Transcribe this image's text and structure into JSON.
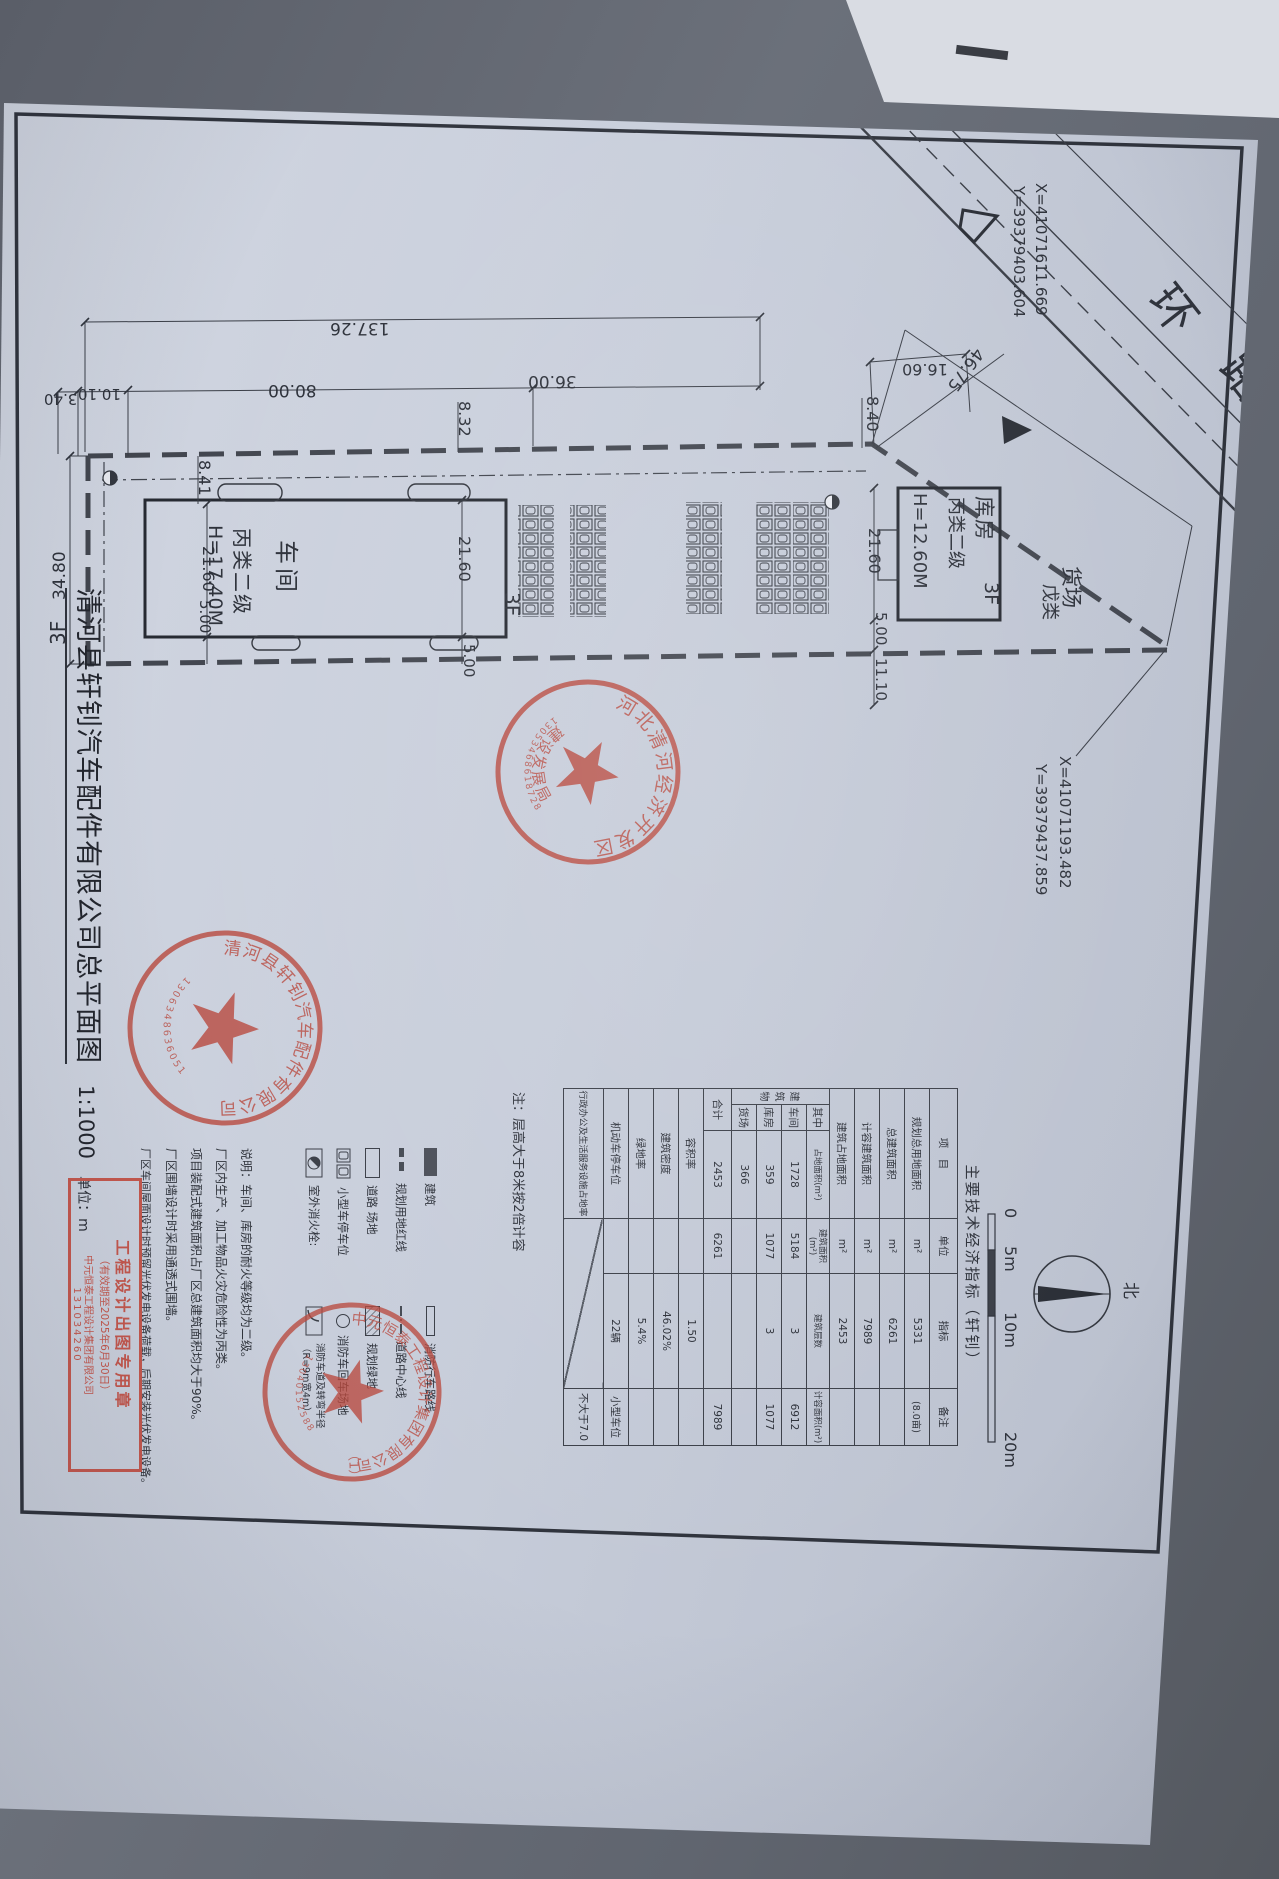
{
  "title_block": {
    "title": "清河县轩钊汽车配件有限公司总平面图",
    "scale": "1:1000",
    "unit": "单位：m"
  },
  "road": {
    "char1": "环",
    "char2": "路"
  },
  "coordinates": {
    "north_corner": {
      "x": "X=41071611.669",
      "y": "Y=39379403.604"
    },
    "east_corner": {
      "x": "X=41071193.482",
      "y": "Y=39379437.859"
    }
  },
  "buildings": {
    "workshop": {
      "name": "车间",
      "fire_class": "丙类二级",
      "height": "H=17.40M",
      "floors": "3F"
    },
    "warehouse": {
      "name": "库房",
      "fire_class": "丙类二级",
      "height": "H=12.60M",
      "floors": "3F"
    },
    "freight_yard": {
      "name": "货场",
      "fire_class": "戊类"
    }
  },
  "dims": {
    "total_length": "137.26",
    "seg_3_40": "3.40",
    "seg_10_10": "10.10",
    "seg_80_00": "80.00",
    "seg_36_00": "36.00",
    "seg_16_60": "16.60",
    "gap_8_40": "8.40",
    "gap_8_32": "8.32",
    "gap_8_41": "8.41",
    "depth_21_60": "21.60",
    "gap_5_00": "5.00",
    "gap_11_10": "11.10",
    "total_width": "34.80",
    "road_frontage": "46.75",
    "floors_3f": "3F"
  },
  "compass": {
    "north": "北"
  },
  "scale_bar": {
    "labels": [
      "0",
      "5m",
      "10m",
      "20m"
    ]
  },
  "economic_table": {
    "title": "主要技术经济指标（轩钊）",
    "note": "注：层高大于8米按2倍计容",
    "headers": {
      "item": "项　目",
      "unit": "单位",
      "value": "指标",
      "remark": "备注"
    },
    "rows_main": [
      {
        "label": "规划总用地面积",
        "unit": "m²",
        "value": "5331",
        "remark": "(8.0亩)"
      },
      {
        "label": "总建筑面积",
        "unit": "m²",
        "value": "6261",
        "remark": ""
      },
      {
        "label": "计容建筑面积",
        "unit": "m²",
        "value": "7989",
        "remark": ""
      },
      {
        "label": "建筑占地面积",
        "unit": "m²",
        "value": "2453",
        "remark": ""
      }
    ],
    "building_section": {
      "group_label": "建筑物",
      "among_label": "其中",
      "sub_headers": [
        "占地面积(m²)",
        "建筑面积(m²)",
        "建筑层数",
        "计容面积(m²)"
      ],
      "rows": [
        {
          "label": "车间",
          "values": [
            "1728",
            "5184",
            "3",
            "6912"
          ]
        },
        {
          "label": "库房",
          "values": [
            "359",
            "1077",
            "3",
            "1077"
          ]
        },
        {
          "label": "货场",
          "values": [
            "366",
            "",
            "",
            ""
          ]
        },
        {
          "label": "合计",
          "values": [
            "2453",
            "6261",
            "",
            "7989"
          ]
        }
      ]
    },
    "rows_bottom": [
      {
        "label": "容积率",
        "value": "1.50",
        "remark": ""
      },
      {
        "label": "建筑密度",
        "value": "46.02%",
        "remark": ""
      },
      {
        "label": "绿地率",
        "value": "5.4%",
        "remark": ""
      },
      {
        "label": "机动车停车位",
        "value": "22辆",
        "remark": "小型车位"
      },
      {
        "label": "行政办公及生活服务设施占地率",
        "value": "",
        "remark": "不大于7.0"
      }
    ]
  },
  "legend": {
    "col1": [
      {
        "label": "建筑"
      },
      {
        "label": "规划用地红线"
      },
      {
        "label": "道路 场地"
      },
      {
        "label": "小型车停车位"
      },
      {
        "label": "室外消火栓:"
      }
    ],
    "col2": [
      {
        "label": "消防行车路线"
      },
      {
        "label": "道路中心线"
      },
      {
        "label": "规划绿地"
      },
      {
        "label": "消防车回车场地"
      },
      {
        "label": "消防车道及转弯半径（R=9m宽4m）"
      }
    ]
  },
  "notes": {
    "lines": [
      "说明：车间、库房的耐火等级均为二级。",
      "厂区内生产、加工物品火灾危险性为丙类。",
      "项目装配式建筑面积占厂区总建筑面积均大于90%。",
      "厂区围墙设计时采用通透式围墙。",
      "厂区车间屋面设计时预留光伏发电设备荷载，后期安装光伏发电设备。"
    ]
  },
  "stamps": {
    "devzone": {
      "ring_top": "河北清河经济开发区",
      "ring_bottom": "建设发展局",
      "serial": "13053468618728"
    },
    "company": {
      "ring": "清河县轩钊汽车配件有限公司",
      "serial": "1306348636051"
    },
    "design": {
      "ring": "中元恒泰工程设计集团有限公司",
      "serial": "13040152588",
      "copy_no": "（1）"
    }
  },
  "export_box": {
    "line1": "工程设计出图专用章",
    "line2": "（有效期至2025年6月30日）",
    "line3": "中元恒泰工程设计集团有限公司",
    "line4": "131034260"
  }
}
